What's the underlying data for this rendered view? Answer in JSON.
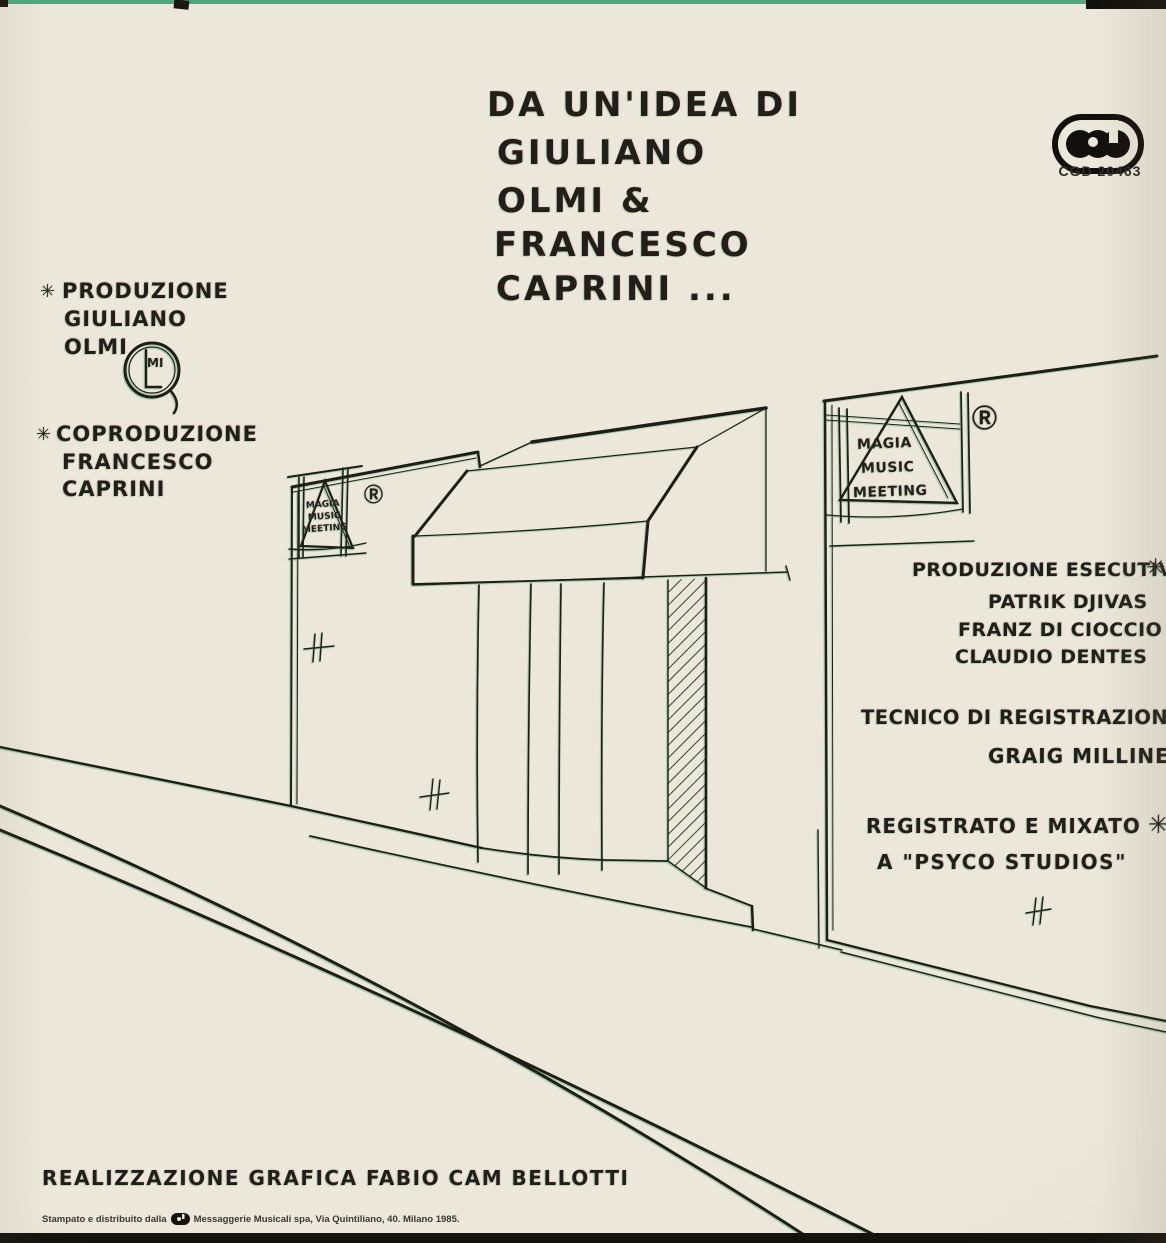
{
  "colors": {
    "paper": "#ebe7da",
    "ink": "#221f19",
    "scan_green": "#2f9e6e"
  },
  "title_block": {
    "lines": [
      "DA UN'IDEA DI",
      "GIULIANO",
      "OLMI &",
      "FRANCESCO",
      "CAPRINI ..."
    ]
  },
  "publisher": {
    "logo_name": "CGD",
    "catalog_number": "CGD 20463"
  },
  "production": {
    "marker": "✳",
    "lines": [
      "PRODUZIONE",
      "GIULIANO",
      "OLMI"
    ],
    "monogram_letters": "MI"
  },
  "coproduction": {
    "marker": "✳",
    "lines": [
      "COPRODUZIONE",
      "FRANCESCO",
      "CAPRINI"
    ]
  },
  "signs": {
    "brand_lines": [
      "MAGIA",
      "MUSIC",
      "MEETING"
    ],
    "registered": "Ⓡ"
  },
  "executive_production": {
    "label": "PRODUZIONE ESECUTIVA",
    "marker": "✳",
    "names": [
      "PATRIK DJIVAS",
      "FRANZ DI CIOCCIO",
      "CLAUDIO DENTES"
    ]
  },
  "recording": {
    "engineer_label": "TECNICO DI REGISTRAZIONE:",
    "engineer_name": "GRAIG MILLINER",
    "mix_label": "REGISTRATO E MIXATO",
    "mix_marker": "✳",
    "studio_line": "A \"PSYCO STUDIOS\""
  },
  "footer": {
    "graphic_design": "REALIZZAZIONE GRAFICA FABIO CAM BELLOTTI",
    "print_before": "Stampato e distribuito dalla",
    "print_after": "Messaggerie Musicali spa, Via Quintiliano, 40. Milano 1985."
  }
}
